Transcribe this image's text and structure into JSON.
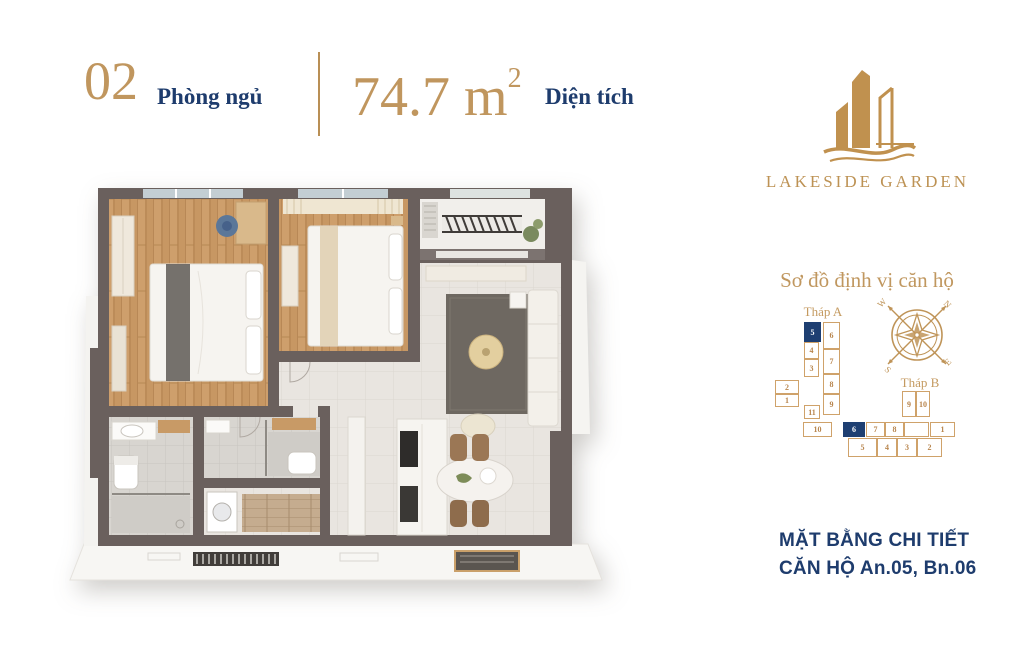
{
  "header": {
    "bedrooms_number": "02",
    "bedrooms_label": "Phòng ngủ",
    "area_value": "74.7 m",
    "area_sup": "2",
    "area_label": "Diện tích"
  },
  "logo": {
    "name": "LAKESIDE GARDEN"
  },
  "locator": {
    "title": "Sơ đồ định vị căn hộ",
    "towers": [
      {
        "label": "Tháp A",
        "units": [
          {
            "n": "5",
            "x": 44,
            "y": 21,
            "w": 17,
            "h": 20,
            "hl": true
          },
          {
            "n": "4",
            "x": 44,
            "y": 41,
            "w": 15,
            "h": 17,
            "hl": false
          },
          {
            "n": "3",
            "x": 44,
            "y": 58,
            "w": 15,
            "h": 18,
            "hl": false
          },
          {
            "n": "2",
            "x": 15,
            "y": 79,
            "w": 24,
            "h": 14,
            "hl": false
          },
          {
            "n": "1",
            "x": 15,
            "y": 93,
            "w": 24,
            "h": 13,
            "hl": false
          },
          {
            "n": "11",
            "x": 44,
            "y": 104,
            "w": 16,
            "h": 14,
            "hl": false
          },
          {
            "n": "10",
            "x": 43,
            "y": 121,
            "w": 29,
            "h": 15,
            "hl": false
          },
          {
            "n": "6",
            "x": 63,
            "y": 21,
            "w": 17,
            "h": 27,
            "hl": false
          },
          {
            "n": "7",
            "x": 63,
            "y": 48,
            "w": 17,
            "h": 25,
            "hl": false
          },
          {
            "n": "8",
            "x": 63,
            "y": 73,
            "w": 17,
            "h": 20,
            "hl": false
          },
          {
            "n": "9",
            "x": 63,
            "y": 93,
            "w": 17,
            "h": 21,
            "hl": false
          }
        ]
      },
      {
        "label": "Tháp B",
        "units": [
          {
            "n": "9",
            "x": 59,
            "y": 16,
            "w": 14,
            "h": 26,
            "hl": false
          },
          {
            "n": "10",
            "x": 73,
            "y": 16,
            "w": 14,
            "h": 26,
            "hl": false
          },
          {
            "n": "6",
            "x": 0,
            "y": 47,
            "w": 22,
            "h": 15,
            "hl": true
          },
          {
            "n": "7",
            "x": 23,
            "y": 47,
            "w": 19,
            "h": 15,
            "hl": false
          },
          {
            "n": "8",
            "x": 42,
            "y": 47,
            "w": 19,
            "h": 15,
            "hl": false
          },
          {
            "n": "",
            "x": 61,
            "y": 47,
            "w": 25,
            "h": 15,
            "hl": false
          },
          {
            "n": "1",
            "x": 87,
            "y": 47,
            "w": 25,
            "h": 15,
            "hl": false
          },
          {
            "n": "5",
            "x": 5,
            "y": 63,
            "w": 29,
            "h": 19,
            "hl": false
          },
          {
            "n": "4",
            "x": 34,
            "y": 63,
            "w": 20,
            "h": 19,
            "hl": false
          },
          {
            "n": "3",
            "x": 54,
            "y": 63,
            "w": 20,
            "h": 19,
            "hl": false
          },
          {
            "n": "2",
            "x": 74,
            "y": 63,
            "w": 25,
            "h": 19,
            "hl": false
          }
        ]
      }
    ],
    "compass": {
      "n": "N",
      "e": "E",
      "s": "S",
      "w": "W"
    }
  },
  "footer": {
    "line1": "MẶT BẰNG CHI TIẾT",
    "line2": "CĂN HỘ An.05, Bn.06"
  },
  "colors": {
    "gold": "#c0965e",
    "navy": "#1e3c6d",
    "unit_highlight": "#1e3f72",
    "wall": "#6a605d",
    "wood_floor": "#c79763",
    "tile_floor": "#e9e5e0"
  }
}
